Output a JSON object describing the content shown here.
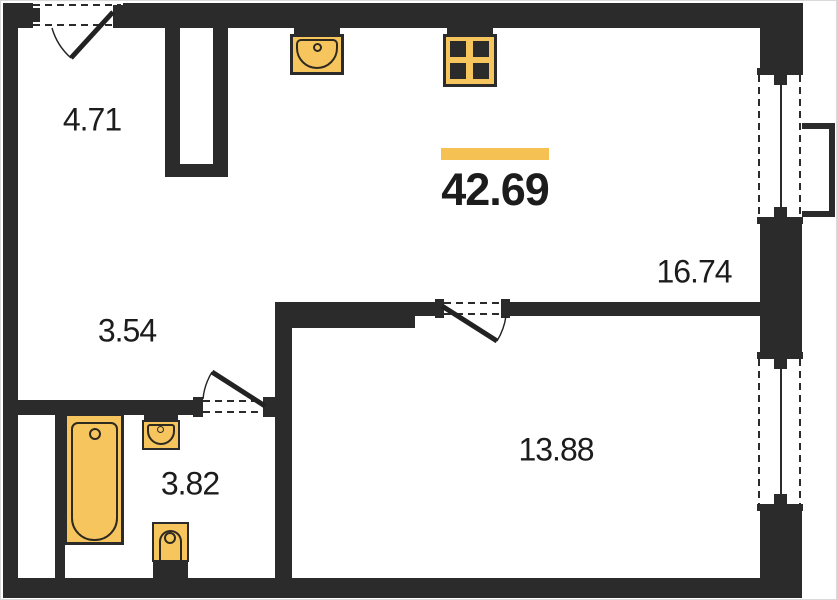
{
  "plan": {
    "total_area": "42.69",
    "rooms": {
      "entry_hall": {
        "area": "4.71"
      },
      "corridor": {
        "area": "3.54"
      },
      "bathroom": {
        "area": "3.82"
      },
      "kitchen_living": {
        "area": "16.74"
      },
      "bedroom": {
        "area": "13.88"
      }
    },
    "fixtures": [
      "kitchen-sink",
      "stove-4-burner",
      "bathtub",
      "washbasin",
      "toilet"
    ],
    "openings": {
      "entry_door": 1,
      "interior_doors": 2,
      "windows": 2,
      "balcony": 1
    },
    "colors": {
      "wall": "#2b2b2b",
      "fixture_fill": "#f6c55e",
      "accent_bar": "#f6c153",
      "text": "#1c1c1c",
      "background": "#ffffff"
    }
  }
}
